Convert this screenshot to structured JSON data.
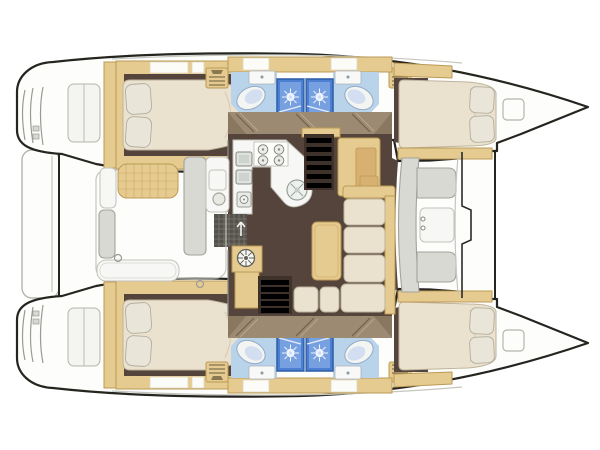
{
  "diagram": {
    "type": "floor-plan",
    "subject": "Catamaran yacht interior deck plan, top view, bow to the right",
    "orientation": "bow-right",
    "hulls": [
      {
        "id": "port-hull",
        "position": "top",
        "rooms": [
          "aft-double-cabin",
          "aft-head",
          "forward-head",
          "forward-double-cabin"
        ],
        "fixtures": [
          "island-berth-2-pillows",
          "toilet",
          "washbasin",
          "shower-stall",
          "shower-stall",
          "toilet",
          "washbasin",
          "berth-2-pillows",
          "bow-deck-hatch",
          "transom-steps"
        ]
      },
      {
        "id": "starboard-hull",
        "position": "bottom",
        "rooms": [
          "aft-double-cabin",
          "aft-head",
          "forward-head",
          "forward-double-cabin"
        ],
        "fixtures": [
          "island-berth-2-pillows",
          "toilet",
          "washbasin",
          "shower-stall",
          "shower-stall",
          "toilet",
          "washbasin",
          "berth-2-pillows",
          "bow-deck-hatch",
          "transom-steps"
        ]
      }
    ],
    "bridge_deck": {
      "aft_cockpit": [
        "cockpit-table",
        "bench-seats",
        "aft-bench",
        "floor-grate",
        "mooring-rings"
      ],
      "salon": [
        "l-shaped-galley",
        "4-burner-stove",
        "double-sink",
        "round-sink",
        "helm-wheel-locker",
        "companionway-stairs-port",
        "companionway-stairs-starboard",
        "dinette-table",
        "l-shaped-settee",
        "nav-cabinet"
      ],
      "forward_cockpit": [
        "c-shaped-bench",
        "forward-table",
        "windshield-bulkhead"
      ]
    }
  },
  "colors": {
    "outline": "#26241f",
    "deck_white": "#fdfdfb",
    "deck_line": "#c6c6bf",
    "beige": "#e6cb90",
    "beige_dark": "#d8b172",
    "beige_border": "#bb9a56",
    "floor_dark": "#54443b",
    "floor_darker": "#3f322b",
    "corridor_tan": "#9c8a72",
    "corridor_streak_dark": "#6d5c49",
    "corridor_streak_light": "#b7a88f",
    "cream": "#eae1cf",
    "cream_border": "#bfb49c",
    "pillow": "#e9e5d9",
    "bath_blue": "#b9d3eb",
    "shower_blue": "#4c7fd1",
    "shower_blue_light": "#7fa6e4",
    "shower_frame": "#2c5da5",
    "fixture_white": "#f7f8f5",
    "fixture_border": "#c2c2ba",
    "gray_bench": "#d9d9d3",
    "gray_border": "#a3a39b",
    "step_wood": "#8f7c6b",
    "grate": "#55524c",
    "grate_line": "#7c7870"
  }
}
